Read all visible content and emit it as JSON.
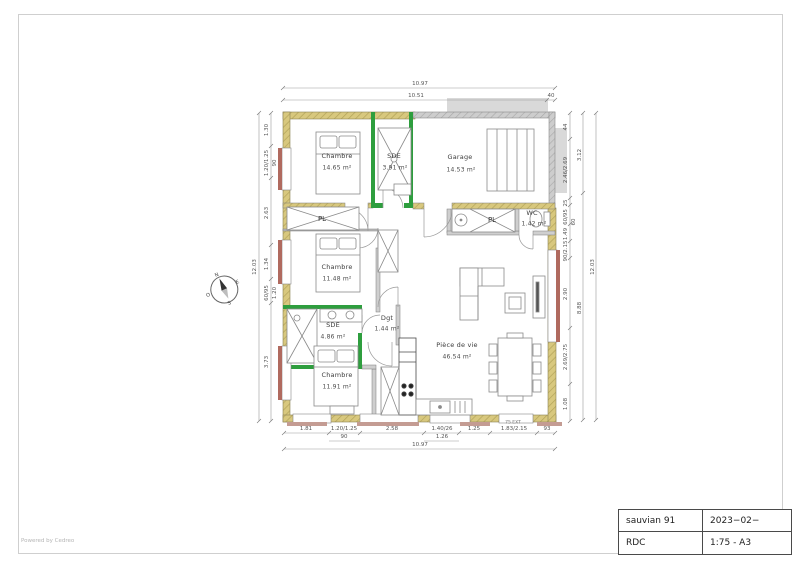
{
  "page": {
    "footer": "Powered by Cedreo"
  },
  "title_block": {
    "project": "sauvian 91",
    "date": "2023−02−",
    "level": "RDC",
    "scale": "1:75 - A3"
  },
  "compass": {
    "n": "N",
    "e": "E",
    "s": "S",
    "o": "O"
  },
  "rooms": {
    "chambre1": {
      "name": "Chambre",
      "area": "14.65 m²"
    },
    "sde1": {
      "name": "SDE",
      "area": "3.91 m²"
    },
    "garage": {
      "name": "Garage",
      "area": "14.53 m²"
    },
    "wc": {
      "name": "WC",
      "area": "1.42 m²"
    },
    "chambre2": {
      "name": "Chambre",
      "area": "11.48 m²"
    },
    "sde2": {
      "name": "SDE",
      "area": "4.86 m²"
    },
    "dgt": {
      "name": "Dgt",
      "area": "1.44 m²"
    },
    "chambre3": {
      "name": "Chambre",
      "area": "11.91 m²"
    },
    "piece_de_vie": {
      "name": "Pièce de vie",
      "area": "46.54 m²"
    }
  },
  "closets": {
    "pl1": "PL",
    "pl2": "PL"
  },
  "dims": {
    "top": {
      "overall": "10.97",
      "inner": "10.51",
      "end": "40"
    },
    "bottom": {
      "s0": "1.81",
      "s1": "1.20/1.25",
      "s1b": "90",
      "s2": "2.58",
      "s3": "1.40/26",
      "s3b": "1.26",
      "s4": "1.25",
      "s5": "1.83/2.15",
      "s5note": "75 EXT",
      "s6": "93",
      "overall": "10.97"
    },
    "left": {
      "s0": "1.30",
      "s1": "1.20/1.25",
      "s1b": "90",
      "s2": "2.63",
      "s3": "1.34",
      "s4": "60/95",
      "s4b": "1.20",
      "s5": "3.73",
      "overall": "12.03"
    },
    "right": {
      "s0": "44",
      "s1": "2.46/2.69",
      "s2": "25",
      "s3": "60/95",
      "s4": "60",
      "s5": "1.49",
      "s6": "90/2.15",
      "s7": "2.90",
      "s8": "2.69/2.75",
      "s9": "1.08",
      "m0": "3.12",
      "m1": "8.88",
      "overall": "12.03"
    }
  },
  "colors": {
    "exterior_wall_hatch": "#d8c87e",
    "garage_wall": "#c2c2c2",
    "green_partition": "#2e9e3e",
    "window_sill": "#b06a5f",
    "sill_beige": "#c49c93",
    "line": "#6d6d6d"
  }
}
